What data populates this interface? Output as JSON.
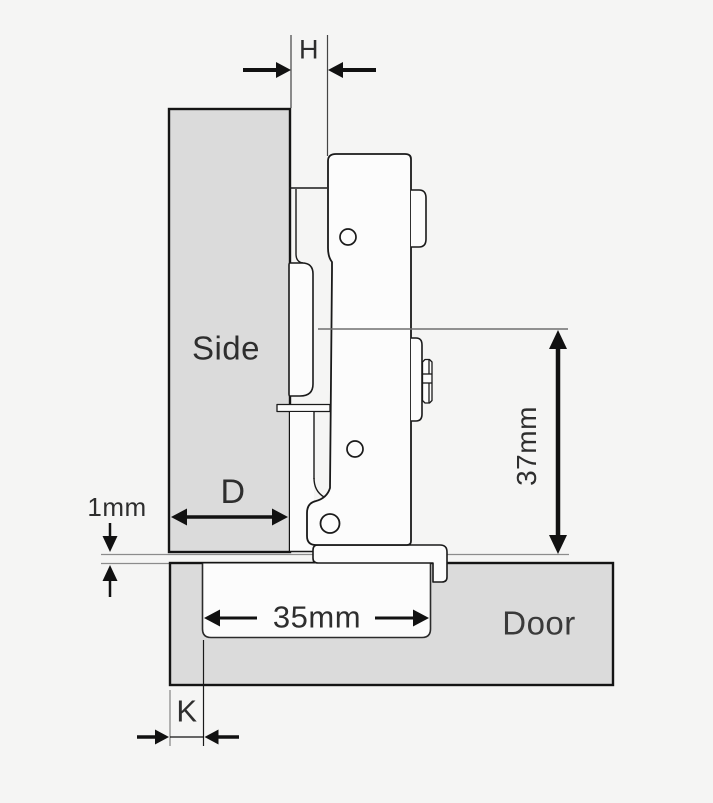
{
  "diagram": {
    "type": "hinge-mounting-cross-section",
    "scene": {
      "background": "#f5f5f4",
      "panel_fill": "#dbdbdb",
      "outline_color": "#1a1a1a",
      "hinge_fill": "#fcfcfc",
      "extension_line_color": "#8c8c8c",
      "text_color": "#2e2e2e"
    },
    "panels": {
      "side_label": "Side",
      "door_label": "Door"
    },
    "dimensions": {
      "reveal_label": "H",
      "mounting_depth_label": "D",
      "panel_gap_label": "1mm",
      "cup_hole_label": "35mm",
      "axis_to_door_label": "37mm",
      "cup_edge_distance_label": "K"
    }
  }
}
